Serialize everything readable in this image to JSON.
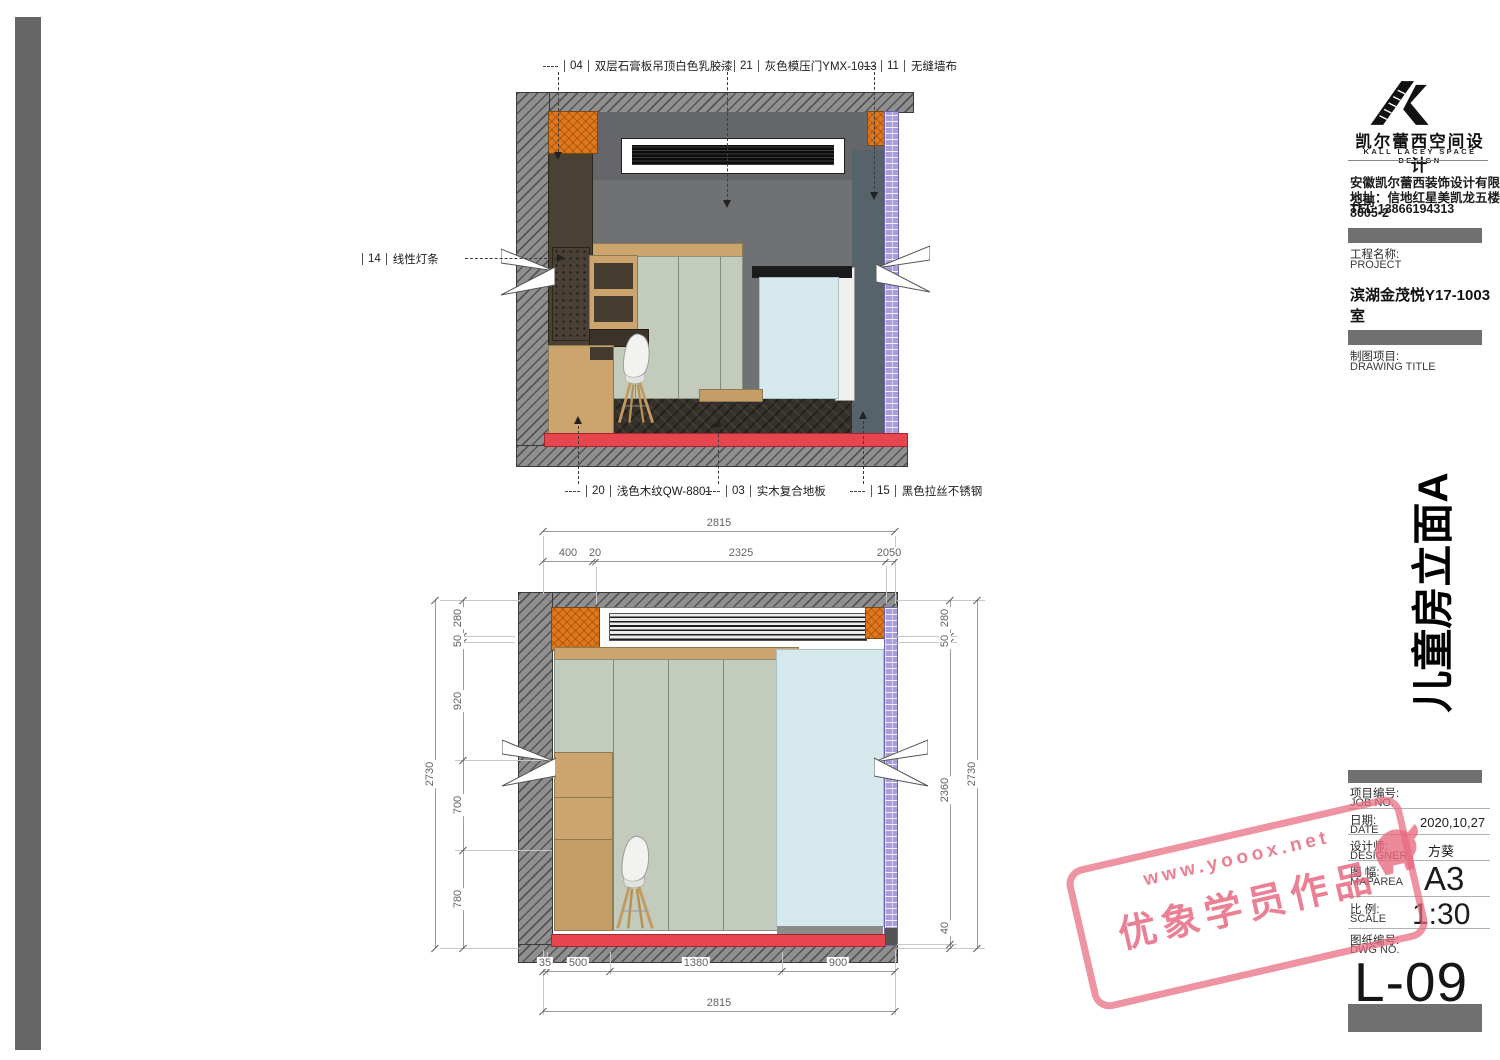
{
  "drawing": {
    "callouts_top": [
      {
        "code": "04",
        "label": "双层石膏板吊顶白色乳胶漆"
      },
      {
        "code": "21",
        "label": "灰色模压门YMX-1013"
      },
      {
        "code": "11",
        "label": "无缝墙布"
      }
    ],
    "callout_left": {
      "code": "14",
      "label": "线性灯条"
    },
    "callouts_bottom": [
      {
        "code": "20",
        "label": "浅色木纹QW-8801"
      },
      {
        "code": "03",
        "label": "实木复合地板"
      },
      {
        "code": "15",
        "label": "黑色拉丝不锈钢"
      }
    ]
  },
  "dims": {
    "top_overall": "2815",
    "top_segments": [
      "400",
      "20",
      "2325",
      "2050"
    ],
    "left_overall": "2730",
    "left_segments": [
      "280",
      "50",
      "920",
      "700",
      "780"
    ],
    "right_overall": "2730",
    "right_segments": [
      "280",
      "50",
      "2360",
      "40"
    ],
    "bottom_segments": [
      "35",
      "500",
      "1380",
      "900"
    ],
    "bottom_overall": "2815"
  },
  "titleblock": {
    "logo_cn": "凯尔蕾西空间设计",
    "logo_en": "KALL LACEY SPACE DESIGN",
    "company": "安徽凯尔蕾西装饰设计有限公司",
    "address": "地址：信地红星美凯龙五楼8005-2",
    "tel": "TEL:13866194313",
    "project_label_cn": "工程名称:",
    "project_label_en": "PROJECT",
    "project_name": "滨湖金茂悦Y17-1003室",
    "drawing_label_cn": "制图项目:",
    "drawing_label_en": "DRAWING TITLE",
    "drawing_title_vertical": "儿童房立面A",
    "rows": [
      {
        "cn": "项目编号:",
        "en": "JOB NO.",
        "value": ""
      },
      {
        "cn": "日期:",
        "en": "DATE",
        "value": "2020,10,27"
      },
      {
        "cn": "设计师:",
        "en": "DESIGNER",
        "value": "方葵"
      },
      {
        "cn": "图 幅:",
        "en": "MAPAREA",
        "value": "A3"
      },
      {
        "cn": "比 例:",
        "en": "SCALE",
        "value": "1:30"
      },
      {
        "cn": "图纸编号:",
        "en": "DWG NO.",
        "value": ""
      }
    ],
    "dwg_no": "L-09"
  },
  "watermark": {
    "line1": "www.yooox.net",
    "line2": "优象学员作品"
  },
  "colors": {
    "wall_hatch": "#8f8f8f",
    "orange": "#e2761c",
    "purple": "#a89ede",
    "sage": "#c2cbbc",
    "door_blue": "#d5e9ec",
    "skirting_red": "#e8464f",
    "wood_light": "#cba46e",
    "wood_dark": "#4a4135",
    "floor_dark": "#35302a",
    "teal_wall": "#57636a",
    "stamp_pink": "#e8697e",
    "left_bar": "#666666"
  }
}
